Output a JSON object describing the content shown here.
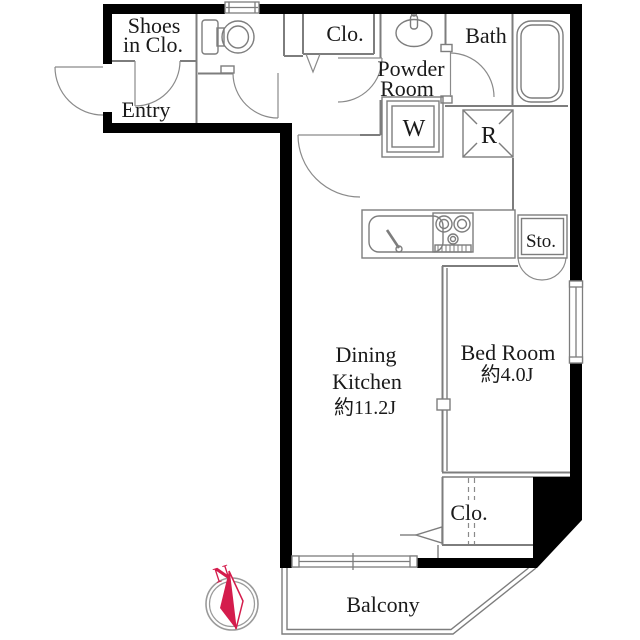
{
  "floor_plan": {
    "rooms": {
      "shoes_closet": {
        "label_lines": [
          "Shoes",
          "in Clo."
        ]
      },
      "entry": {
        "label": "Entry"
      },
      "closet_top": {
        "label": "Clo."
      },
      "powder_room": {
        "label_lines": [
          "Powder",
          "Room"
        ]
      },
      "bath": {
        "label": "Bath"
      },
      "dining_kitchen": {
        "label_lines": [
          "Dining",
          "Kitchen"
        ],
        "area": "約11.2J"
      },
      "bed_room": {
        "label": "Bed Room",
        "area": "約4.0J"
      },
      "closet_bottom": {
        "label": "Clo."
      },
      "storage": {
        "label": "Sto."
      },
      "balcony": {
        "label": "Balcony"
      }
    },
    "fixtures": {
      "washing_machine": {
        "label": "W"
      },
      "refrigerator": {
        "label": "R"
      }
    },
    "compass": {
      "label": "N",
      "color": "#d41c4c"
    },
    "colors": {
      "wall": "#000000",
      "interior_line": "#7d7d7d",
      "text": "#1a1a1a",
      "background": "#ffffff"
    }
  }
}
